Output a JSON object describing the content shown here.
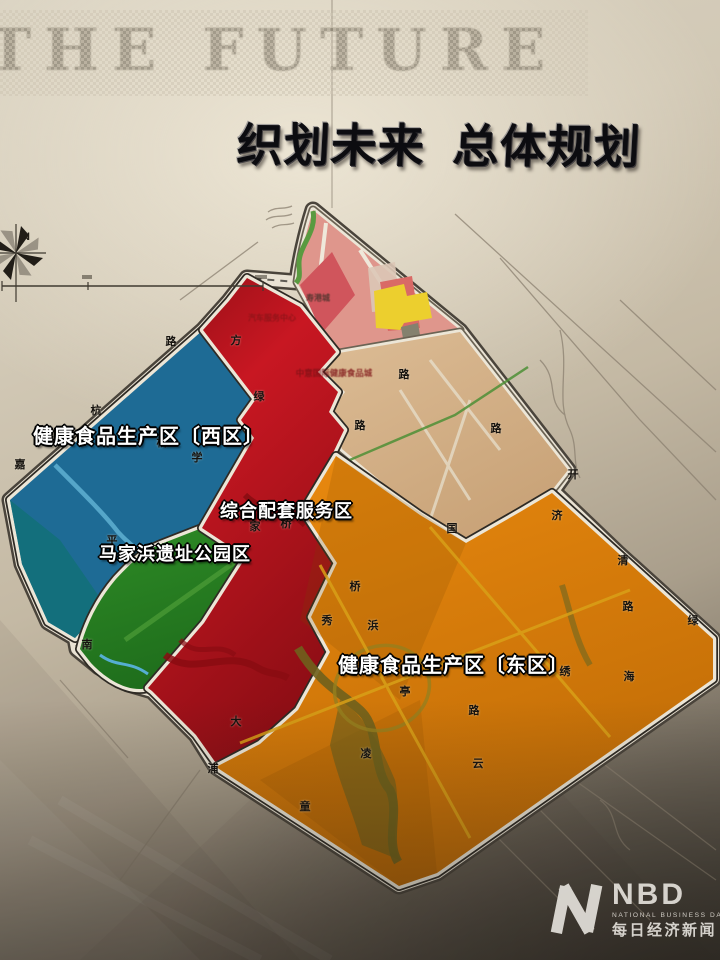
{
  "header": {
    "watermark": "THE FUTURE",
    "title_part1": "织划未来",
    "title_part2": "总体规划"
  },
  "compass": {
    "north_label": "N"
  },
  "colors": {
    "zone_west_blue": "#1e6b95",
    "zone_west_teal": "#13707a",
    "zone_park_green": "#2e8b26",
    "zone_park_green_dark": "#1f6e1c",
    "zone_service_red_light": "#c81722",
    "zone_service_red_dark": "#8f0e15",
    "zone_east_orange_light": "#e8880e",
    "zone_east_orange_dark": "#bd6a06",
    "tan_light": "#dcbc95",
    "tan_dark": "#c9a378",
    "pink_salmon": "#df968c",
    "pink_red_block": "#d0555c",
    "pink_red_block2": "#d96a66",
    "pale_block": "#dcc6b6",
    "yellow_block": "#eccf2e",
    "gray_block": "#84816e",
    "pale_pink_block": "#e9c4c6",
    "green_belt": "#5a9a40",
    "road_white": "#ece6d7",
    "river_blue": "#5fb0d2",
    "river_dark_red": "#8a0c12",
    "river_olive": "#6f611c",
    "yellow_road": "#d8a018"
  },
  "zones": [
    {
      "id": "west",
      "label": "健康食品生产区〔西区〕",
      "label_x": 33,
      "label_y": 420,
      "label_size": 20
    },
    {
      "id": "service",
      "label": "综合配套服务区",
      "label_x": 220,
      "label_y": 497,
      "label_size": 18
    },
    {
      "id": "park",
      "label": "马家浜遗址公园区",
      "label_x": 99,
      "label_y": 540,
      "label_size": 18
    },
    {
      "id": "east",
      "label": "健康食品生产区〔东区〕",
      "label_x": 338,
      "label_y": 649,
      "label_size": 20
    }
  ],
  "road_labels": [
    {
      "ch": "杭",
      "x": 96,
      "y": 410
    },
    {
      "ch": "嘉",
      "x": 20,
      "y": 464
    },
    {
      "ch": "路",
      "x": 171,
      "y": 341
    },
    {
      "ch": "方",
      "x": 236,
      "y": 340
    },
    {
      "ch": "绿",
      "x": 259,
      "y": 396
    },
    {
      "ch": "桥",
      "x": 162,
      "y": 442
    },
    {
      "ch": "学",
      "x": 197,
      "y": 457
    },
    {
      "ch": "平",
      "x": 112,
      "y": 540
    },
    {
      "ch": "南",
      "x": 87,
      "y": 644
    },
    {
      "ch": "家",
      "x": 255,
      "y": 526
    },
    {
      "ch": "桥",
      "x": 286,
      "y": 523
    },
    {
      "ch": "路",
      "x": 404,
      "y": 374
    },
    {
      "ch": "路",
      "x": 360,
      "y": 425
    },
    {
      "ch": "路",
      "x": 496,
      "y": 428
    },
    {
      "ch": "开",
      "x": 573,
      "y": 474
    },
    {
      "ch": "国",
      "x": 452,
      "y": 528
    },
    {
      "ch": "济",
      "x": 557,
      "y": 515
    },
    {
      "ch": "清",
      "x": 623,
      "y": 560
    },
    {
      "ch": "路",
      "x": 628,
      "y": 606
    },
    {
      "ch": "绿",
      "x": 693,
      "y": 620
    },
    {
      "ch": "绣",
      "x": 565,
      "y": 671
    },
    {
      "ch": "海",
      "x": 629,
      "y": 676
    },
    {
      "ch": "桥",
      "x": 355,
      "y": 586
    },
    {
      "ch": "浜",
      "x": 373,
      "y": 625
    },
    {
      "ch": "秀",
      "x": 327,
      "y": 620
    },
    {
      "ch": "亭",
      "x": 405,
      "y": 691
    },
    {
      "ch": "大",
      "x": 236,
      "y": 721
    },
    {
      "ch": "浦",
      "x": 213,
      "y": 768
    },
    {
      "ch": "童",
      "x": 305,
      "y": 806
    },
    {
      "ch": "凌",
      "x": 366,
      "y": 753
    },
    {
      "ch": "云",
      "x": 478,
      "y": 763
    },
    {
      "ch": "路",
      "x": 474,
      "y": 710
    }
  ],
  "poi_labels": [
    {
      "text": "寿港城",
      "x": 318,
      "y": 298,
      "size": 8,
      "color": "#4a332c",
      "opacity": 0.9
    },
    {
      "text": "汽车服务中心",
      "x": 272,
      "y": 318,
      "size": 8,
      "color": "#8a1418",
      "opacity": 0.85
    },
    {
      "text": "中意国际健康食品城",
      "x": 334,
      "y": 373,
      "size": 8.5,
      "color": "#7e1216",
      "opacity": 0.85
    }
  ],
  "watermark_logo": {
    "abbr": "NBD",
    "full": "NATIONAL BUSINESS DAILY",
    "chinese": "每日经济新闻"
  }
}
